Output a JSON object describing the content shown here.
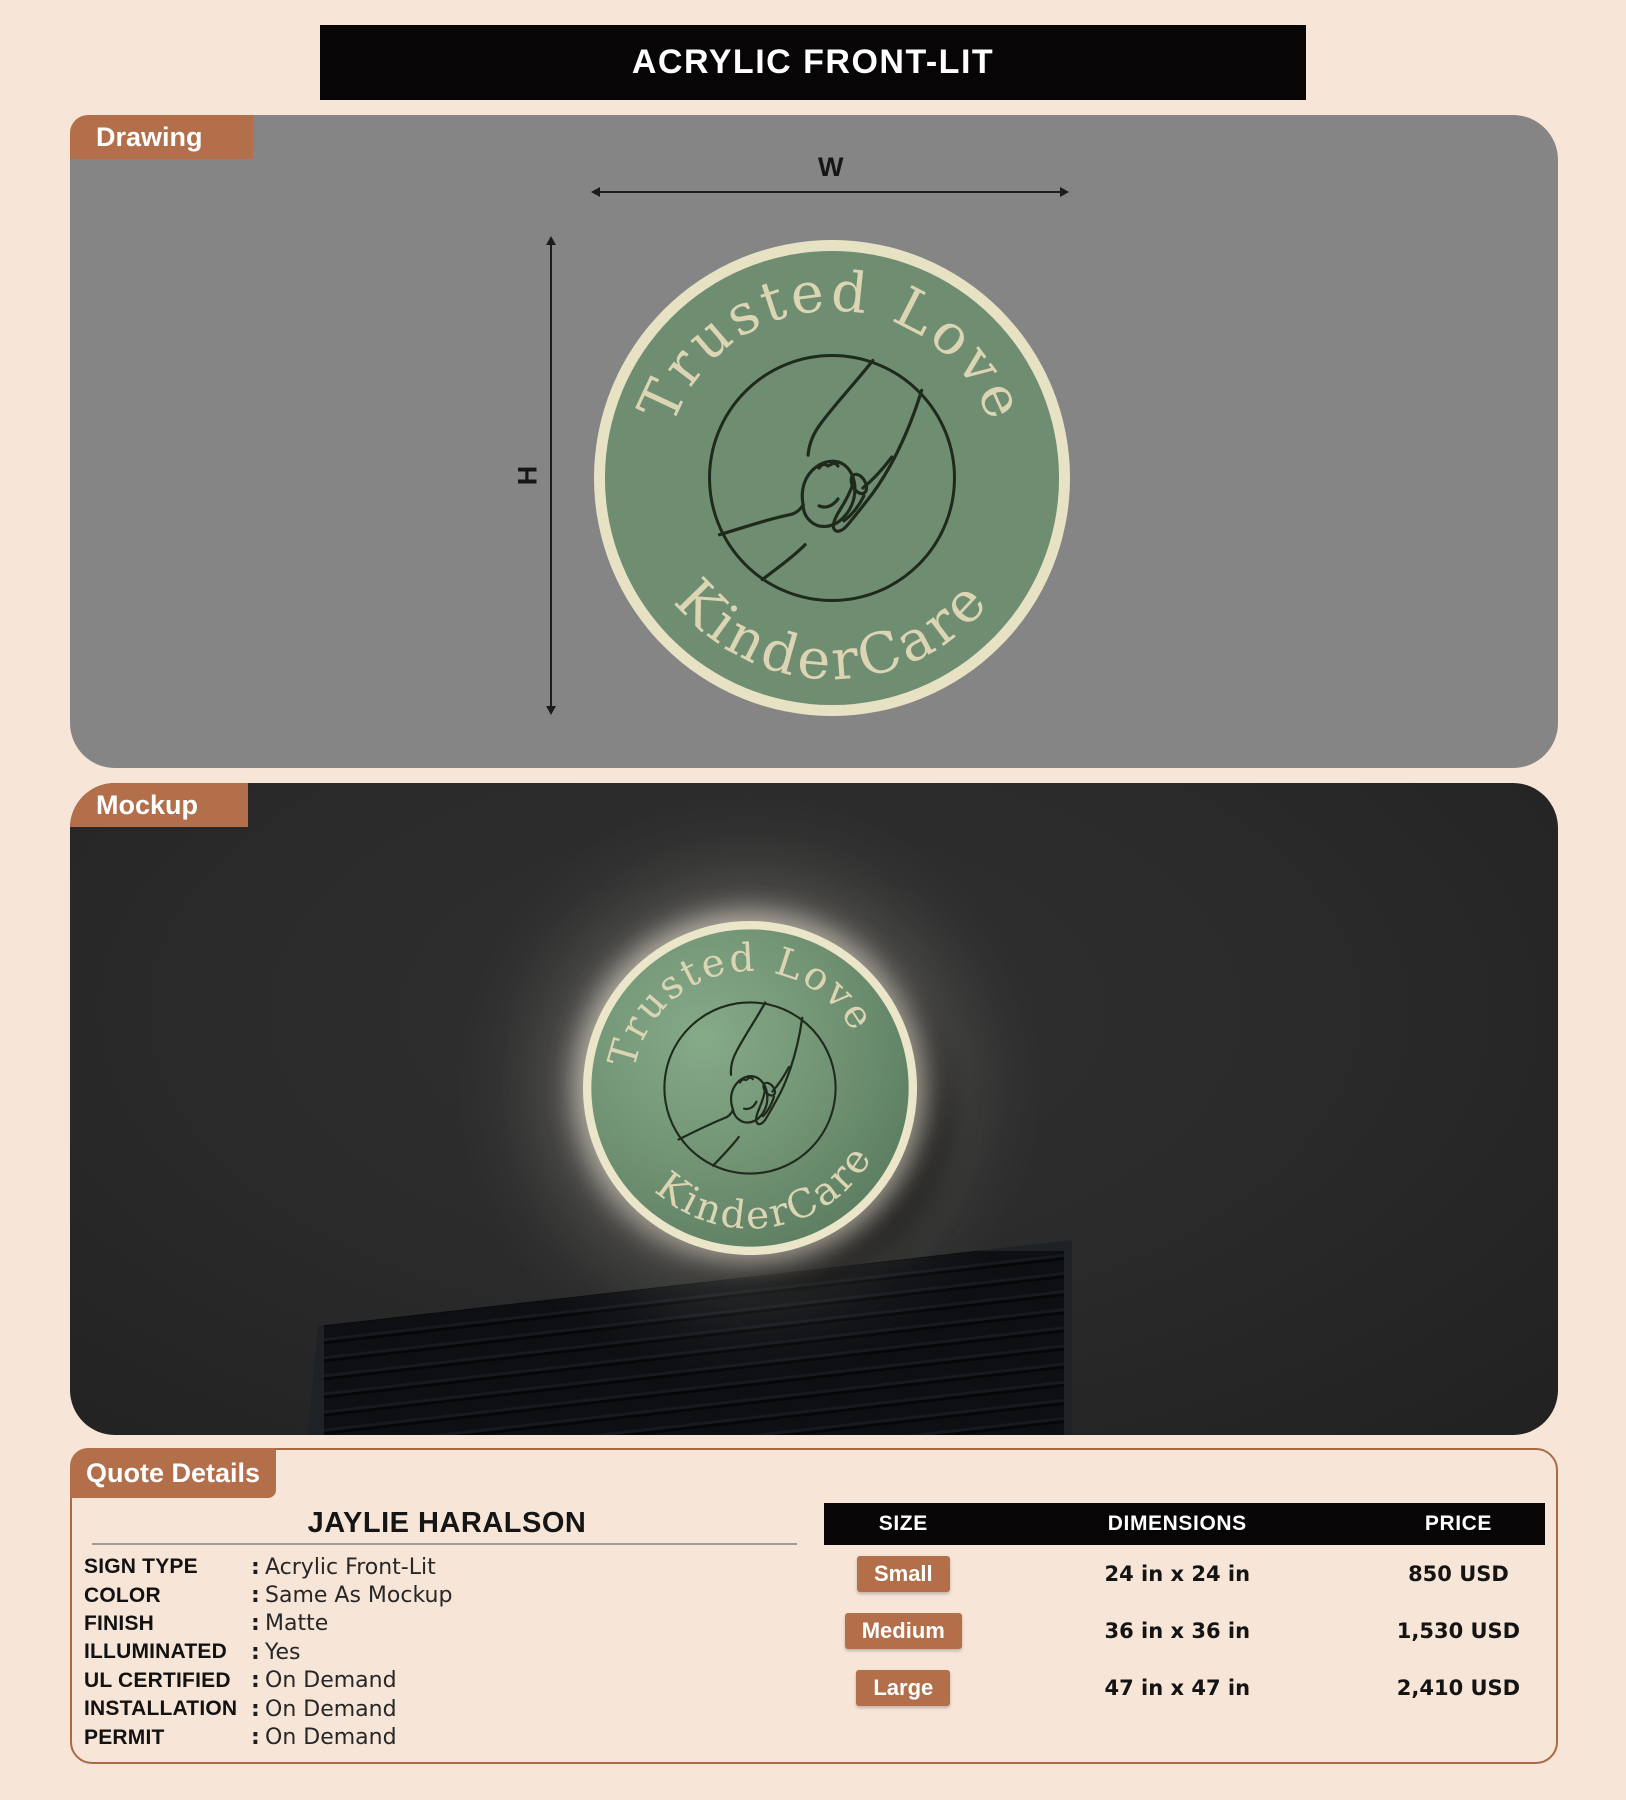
{
  "banner": {
    "title": "ACRYLIC FRONT-LIT",
    "bg": "#070505",
    "text_color": "#ffffff"
  },
  "sections": {
    "drawing": {
      "label": "Drawing"
    },
    "mockup": {
      "label": "Mockup"
    },
    "quote": {
      "label": "Quote Details"
    }
  },
  "drawing": {
    "width_label": "W",
    "height_label": "H"
  },
  "logo": {
    "arc_top": "Trusted Love",
    "arc_bottom": "KinderCare"
  },
  "quote": {
    "customer_name": "JAYLIE HARALSON",
    "separator": ":",
    "fields": [
      {
        "label": "SIGN TYPE",
        "value": "Acrylic Front-Lit"
      },
      {
        "label": "COLOR",
        "value": "Same As Mockup"
      },
      {
        "label": "FINISH",
        "value": "Matte"
      },
      {
        "label": "ILLUMINATED",
        "value": "Yes"
      },
      {
        "label": "UL CERTIFIED",
        "value": "On Demand"
      },
      {
        "label": "INSTALLATION",
        "value": "On Demand"
      },
      {
        "label": "PERMIT",
        "value": "On Demand"
      }
    ],
    "table": {
      "headers": [
        "SIZE",
        "DIMENSIONS",
        "PRICE"
      ],
      "rows": [
        {
          "size": "Small",
          "dimensions": "24 in x 24 in",
          "price": "850 USD"
        },
        {
          "size": "Medium",
          "dimensions": "36 in x 36 in",
          "price": "1,530 USD"
        },
        {
          "size": "Large",
          "dimensions": "47 in x 47 in",
          "price": "2,410 USD"
        }
      ]
    }
  },
  "colors": {
    "page_bg": "#f7e5d8",
    "accent_brown": "#b26f4a",
    "drawing_panel_gray": "#858585",
    "mockup_panel_dark": "#2b2b2b",
    "header_black": "#070505",
    "logo_green": "#6f8d70",
    "logo_cream": "#e8e2c5",
    "quote_border_brown": "#a96b45"
  }
}
